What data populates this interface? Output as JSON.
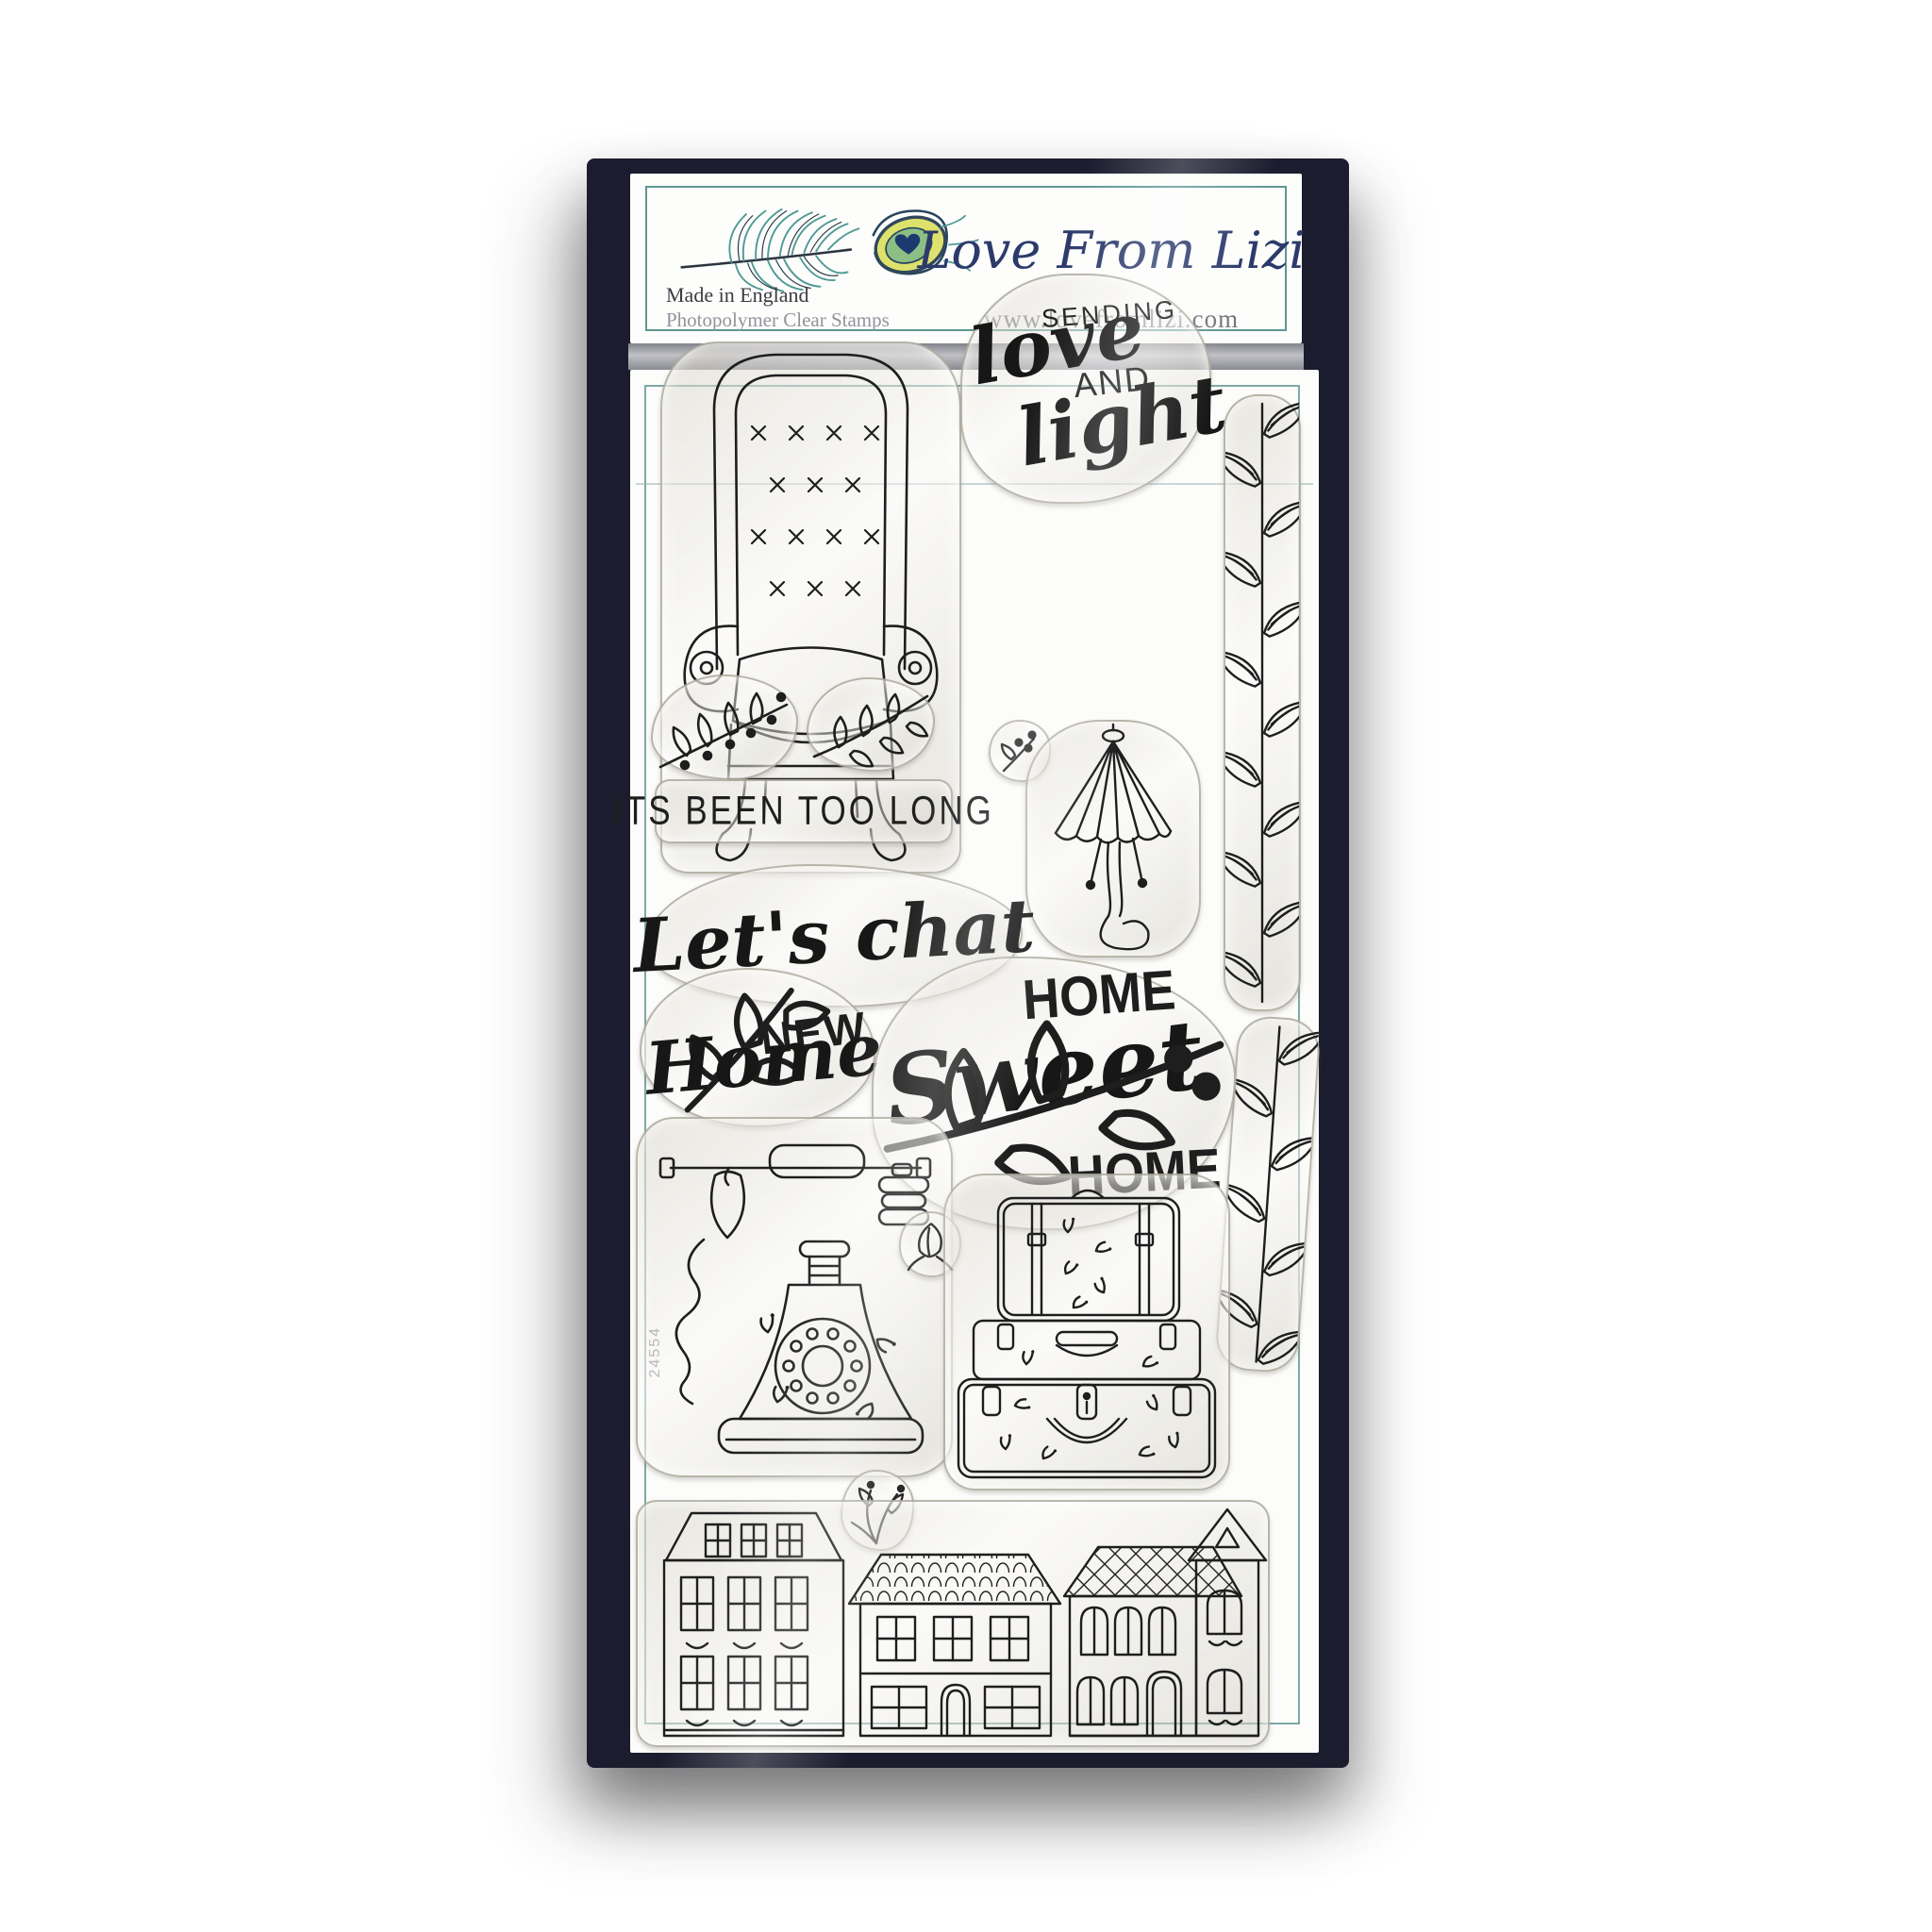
{
  "header": {
    "brand": "Love From Lizi",
    "made_in": "Made in England",
    "product_type": "Photopolymer Clear Stamps",
    "website": "www.lovefromlizi.com"
  },
  "colors": {
    "box_navy": "#1b1c2e",
    "logo_navy": "#2c3a6b",
    "card_border_teal": "#7fa9a5",
    "header_border_teal": "#5d9793",
    "stamp_ink": "#1e1e1e",
    "feather_teal": "#4e9a94"
  },
  "card": {
    "product_number": "24554"
  },
  "stamps": {
    "armchair": {
      "icon": "armchair-stamp"
    },
    "sending_love": {
      "word1": "SENDING",
      "word2": "love",
      "word3": "AND",
      "word4": "light"
    },
    "leaf_border": {
      "icon": "leaf-vine-border-stamp"
    },
    "sprig_left": {
      "icon": "berry-branch-stamp"
    },
    "sprig_right": {
      "icon": "leaf-branch-stamp"
    },
    "tiny_sprig": {
      "icon": "berry-bud-stamp"
    },
    "been_too_long": {
      "text": "ITS BEEN TOO LONG"
    },
    "lamp": {
      "icon": "fringe-lamp-stamp"
    },
    "lets_chat": {
      "text": "Let's chat"
    },
    "new_home": {
      "word1": "NEW",
      "word2": "Home"
    },
    "home_sweet_home": {
      "word1": "HOME",
      "word2": "Sweet",
      "word3": "HOME"
    },
    "telephone": {
      "icon": "vintage-telephone-stamp"
    },
    "bud": {
      "icon": "flower-bud-stamp"
    },
    "suitcases": {
      "icon": "suitcase-stack-stamp"
    },
    "small_leaf": {
      "icon": "leaf-cluster-stamp"
    },
    "houses": {
      "icon": "row-houses-stamp"
    }
  }
}
